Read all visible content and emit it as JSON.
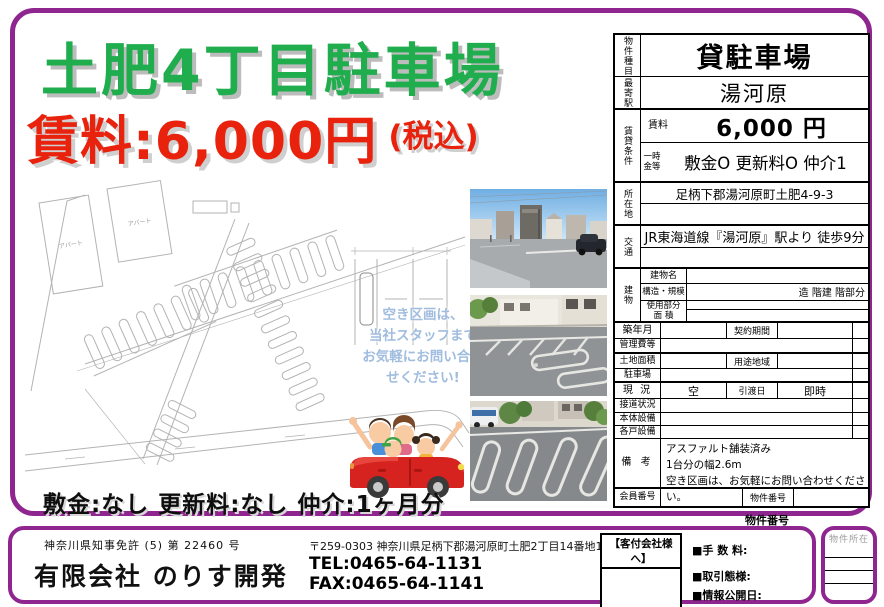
{
  "colors": {
    "border_purple": "#8F2690",
    "title_green": "#1FAD4D",
    "price_red": "#E8220D",
    "bubble_blue": "#A0BCDE"
  },
  "flyer": {
    "title": "土肥4丁目駐車場",
    "price": "賃料:6,000円",
    "price_tax": "(税込)",
    "bubble_lines": [
      "空き区画は、",
      "当社スタッフまで",
      "お気軽にお問い合わ",
      "せください!"
    ],
    "terms": "敷金:なし  更新料:なし  仲介:1ヶ月分"
  },
  "siteplan": {
    "apartment_label": "アパート"
  },
  "table": {
    "type_label": "物件種目",
    "type_value": "貸駐車場",
    "station_label": "最寄駅",
    "station_value": "湯河原",
    "terms_label": "賃貸条件",
    "rent_label": "賃料",
    "rent_value": "6,000 円",
    "onetime_label": "一時金等",
    "onetime_value": "敷金O 更新料O 仲介1",
    "address_label": "所在地",
    "address_value": "足柄下郡湯河原町土肥4-9-3",
    "access_label": "交通",
    "access_value": "JR東海道線『湯河原』駅より 徒歩9分",
    "building_label": "建物",
    "building_name_label": "建物名",
    "structure_label": "構造・規模",
    "structure_value": "造  階建  階部分",
    "area_label": "使用部分 面 積",
    "built_label": "築年月",
    "contract_label": "契約期間",
    "mgmt_label": "管理費等",
    "land_label": "土地面積",
    "zoning_label": "用途地域",
    "parking_label": "駐車場",
    "status_label": "現 況",
    "status_value": "空",
    "handover_label": "引渡日",
    "handover_value": "即時",
    "roadside_label": "接道状況",
    "equip_label": "本体設備",
    "unitequip_label": "各戸設備",
    "remarks_label": "備 考",
    "remarks": [
      "アスファルト舗装済み",
      "1台分の幅2.6m",
      "空き区画は、お気軽にお問い合わせください。"
    ],
    "member_label": "会員番号",
    "propno_label": "物件番号"
  },
  "footer": {
    "license": "神奈川県知事免許 (5) 第  22460  号",
    "company": "有限会社 のりす開発",
    "address": "〒259-0303 神奈川県足柄下郡湯河原町土肥2丁目14番地10",
    "tel": "TEL:0465-64-1131",
    "fax": "FAX:0465-64-1141",
    "agent_label": "【客付会社様へ】",
    "fee_label": "■手 数 料:",
    "transaction_label": "■取引態様:",
    "disclosure_label": "■情報公開日:",
    "property_no_label": "物件番号",
    "property_loc_label": "物件所在"
  }
}
